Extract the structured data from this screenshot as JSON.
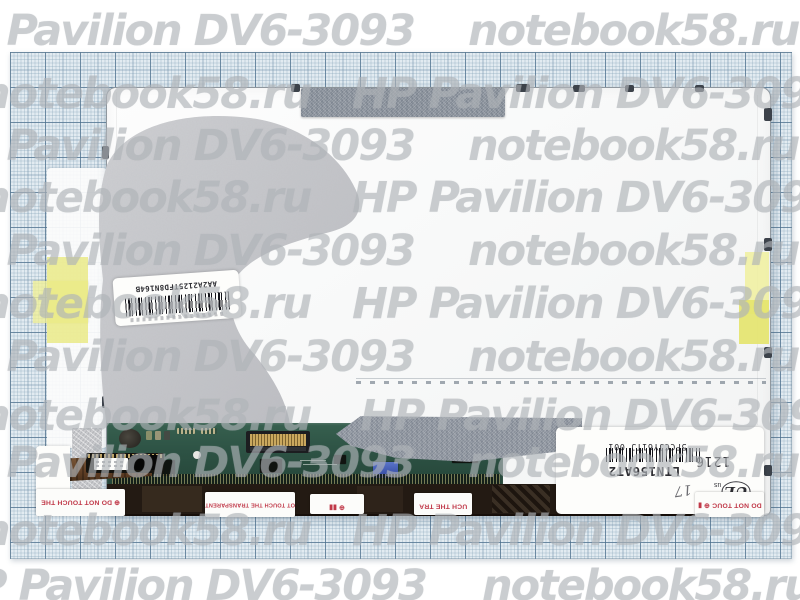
{
  "photo": {
    "subject": "Laptop LCD screen panel on millimeter graph paper",
    "made_in": "MADE IN CHINA"
  },
  "watermark": {
    "brand": "notebook58.ru",
    "model": "HP Pavilion DV6-3093",
    "rows": [
      {
        "y": 8,
        "items": [
          {
            "t": "model",
            "x": -70
          },
          {
            "t": "brand",
            "x": 468
          }
        ]
      },
      {
        "y": 71,
        "items": [
          {
            "t": "brand",
            "x": -20
          },
          {
            "t": "model",
            "x": 352
          }
        ]
      },
      {
        "y": 123,
        "items": [
          {
            "t": "model",
            "x": -70
          },
          {
            "t": "brand",
            "x": 468
          }
        ]
      },
      {
        "y": 175,
        "items": [
          {
            "t": "brand",
            "x": -20
          },
          {
            "t": "model",
            "x": 352
          }
        ]
      },
      {
        "y": 228,
        "items": [
          {
            "t": "model",
            "x": -70
          },
          {
            "t": "brand",
            "x": 468
          }
        ]
      },
      {
        "y": 281,
        "items": [
          {
            "t": "brand",
            "x": -20
          },
          {
            "t": "model",
            "x": 352
          }
        ]
      },
      {
        "y": 334,
        "items": [
          {
            "t": "model",
            "x": -70
          },
          {
            "t": "brand",
            "x": 468
          }
        ]
      },
      {
        "y": 393,
        "items": [
          {
            "t": "brand",
            "x": -20
          },
          {
            "t": "model",
            "x": 360
          }
        ]
      },
      {
        "y": 440,
        "items": [
          {
            "t": "model",
            "x": -70
          },
          {
            "t": "brand",
            "x": 468
          }
        ]
      },
      {
        "y": 508,
        "items": [
          {
            "t": "brand",
            "x": -20
          },
          {
            "t": "model",
            "x": 352
          }
        ]
      },
      {
        "y": 563,
        "items": [
          {
            "t": "model",
            "x": -58
          },
          {
            "t": "brand",
            "x": 482
          }
        ]
      }
    ]
  },
  "labels": {
    "main": {
      "serial": "5FCCJY61TJ 001",
      "model": "LTN156AT2",
      "date_code": "1216",
      "ce": "CE",
      "ul_left": "c",
      "ul_main": "UL",
      "ul_right": "us",
      "handwritten": "17",
      "made_in": "MADE IN CHINA"
    },
    "side": {
      "code": "AA2A2125TFD8N164B"
    },
    "warning": {
      "touch_mark": "⊕ DO NOT TOUCH THE",
      "touch": "DO NOT TOUCH THE",
      "transparent": "DO NOT TOUCH THE TRANSPARENT",
      "transparent_mark": "⊕ DO NOT TOUCH THE TRANSPARENT",
      "stamp_row_a": "⊕ ▮▮",
      "stamp_row_b": "▮ ⊕",
      "partial_mid_1": "UCH THE TRA",
      "partial_mid_2": "UCH THE TRA",
      "partial_right_1": "DO NOT TOUC ⊕ ▮",
      "partial_right_2": "⊕ DO NOT TOU"
    }
  },
  "colors": {
    "paper": "#e2ebf1",
    "grid_major": "#4a6c8a",
    "panel_white": "#f9fafa",
    "pcb_green": "#2d5244",
    "yellow_tape": "#ececa0",
    "gray_foil": "#c8c9cc",
    "gray_tape": "#969da6",
    "warning_red": "#c03848",
    "dark_strip": "#231a13",
    "blue_component": "#3a55b0"
  }
}
